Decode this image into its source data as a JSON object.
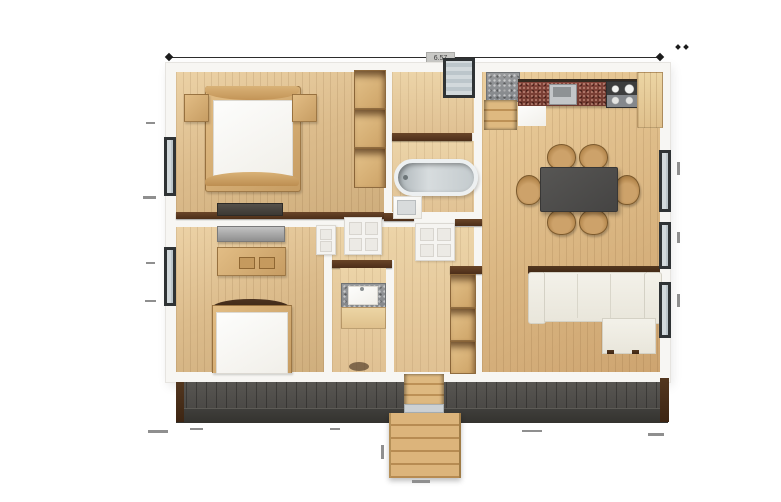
{
  "meta": {
    "type": "top-down 3D floor plan rendering",
    "background": "#ffffff"
  },
  "dimensions": {
    "top_width_label": "6.57"
  },
  "palette": {
    "floor_wood": "#dcbc8c",
    "wall_white": "#f7f6f3",
    "wall_cap_brown": "#4c2e19",
    "deck_gray": "#4a4845",
    "stair_wood": "#d2a86f",
    "granite_red": "#6e382e",
    "counter_gray": "#8f9092",
    "table_dark": "#4d4c4a",
    "chair_wood": "#b5884e",
    "sofa_ivory": "#eeece3",
    "tub_gray": "#c6ccd0",
    "window_frame": "#2f3335"
  },
  "floorplan": {
    "windows": {
      "left_wall": 2,
      "top_wall": 1,
      "right_wall": 3
    },
    "rooms": [
      {
        "name": "bedroom-upper-left",
        "furniture": [
          "double-bed",
          "nightstand-left",
          "nightstand-right",
          "open-wardrobe-shelves",
          "media-console"
        ]
      },
      {
        "name": "bedroom-lower-left",
        "furniture": [
          "gray-dresser",
          "writing-desk",
          "single-bed"
        ]
      },
      {
        "name": "bathroom",
        "furniture": [
          "bathtub",
          "sink-vanity"
        ]
      },
      {
        "name": "utility-wc",
        "furniture": [
          "counter-sink",
          "wood-counter"
        ]
      },
      {
        "name": "hallway-entry",
        "furniture": [
          "open-shelving",
          "interior-door",
          "interior-door"
        ]
      },
      {
        "name": "kitchen-dining-living",
        "furniture": [
          "corner-counter",
          "granite-countertop",
          "kitchen-sink",
          "four-burner-cooktop",
          "tall-cabinet",
          "step-up",
          "dining-table",
          "dining-chairs-x6",
          "l-shaped-sofa"
        ]
      },
      {
        "name": "exterior",
        "furniture": [
          "rear-deck",
          "deck-stairwell",
          "entry-staircase"
        ]
      }
    ]
  }
}
